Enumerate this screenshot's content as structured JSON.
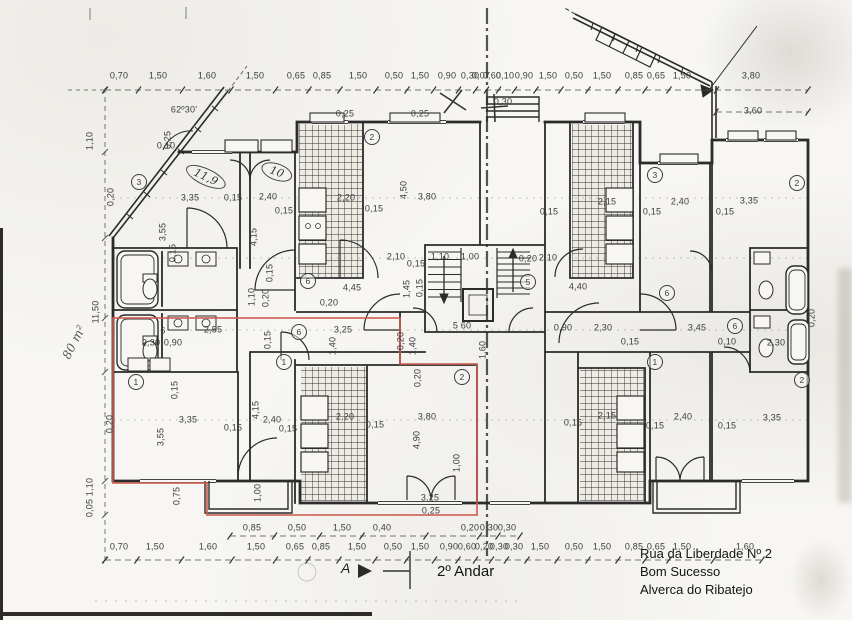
{
  "title": {
    "floor": "2º Andar",
    "section_marker": "A"
  },
  "address": {
    "line1": "Rua da Liberdade Nº 2",
    "line2": "Bom Sucesso",
    "line3": "Alverca do Ribatejo"
  },
  "colors": {
    "ink": "#2b2b2b",
    "red_outline": "#cd5c51",
    "paper": "#f7f6f2"
  },
  "dimension_rows": [
    {
      "name": "top",
      "y": 90,
      "label_y": 76,
      "x0": 105,
      "x1": 808,
      "labels": [
        {
          "t": "0,70",
          "x": 119
        },
        {
          "t": "1,50",
          "x": 158
        },
        {
          "t": "1,60",
          "x": 207
        },
        {
          "t": "1,50",
          "x": 255
        },
        {
          "t": "0,65",
          "x": 296
        },
        {
          "t": "0,85",
          "x": 322
        },
        {
          "t": "1,50",
          "x": 358
        },
        {
          "t": "0,50",
          "x": 394
        },
        {
          "t": "1,50",
          "x": 420
        },
        {
          "t": "0,90",
          "x": 447
        },
        {
          "t": "0,30",
          "x": 470
        },
        {
          "t": "0,07",
          "x": 481
        },
        {
          "t": "0,60",
          "x": 492
        },
        {
          "t": "0,10",
          "x": 505
        },
        {
          "t": "0,90",
          "x": 524
        },
        {
          "t": "1,50",
          "x": 548
        },
        {
          "t": "0,50",
          "x": 574
        },
        {
          "t": "1,50",
          "x": 602
        },
        {
          "t": "0,85",
          "x": 634
        },
        {
          "t": "0,65",
          "x": 656
        },
        {
          "t": "1,50",
          "x": 682
        },
        {
          "t": "3,80",
          "x": 751
        }
      ]
    },
    {
      "name": "top-extra",
      "y": 112,
      "label_y": 111,
      "x0": 716,
      "x1": 808,
      "labels": [
        {
          "t": "3,60",
          "x": 753
        }
      ]
    },
    {
      "name": "bottom",
      "y": 560,
      "label_y": 547,
      "x0": 105,
      "x1": 762,
      "labels": [
        {
          "t": "0,70",
          "x": 119
        },
        {
          "t": "1,50",
          "x": 155
        },
        {
          "t": "1,60",
          "x": 208
        },
        {
          "t": "1,50",
          "x": 256
        },
        {
          "t": "0,65",
          "x": 295
        },
        {
          "t": "0,85",
          "x": 321
        },
        {
          "t": "1,50",
          "x": 357
        },
        {
          "t": "0,50",
          "x": 393
        },
        {
          "t": "1,50",
          "x": 420
        },
        {
          "t": "0,90",
          "x": 449
        },
        {
          "t": "0,60",
          "x": 467
        },
        {
          "t": "0,20",
          "x": 484
        },
        {
          "t": "0,30",
          "x": 499
        },
        {
          "t": "0,30",
          "x": 514
        },
        {
          "t": "1,50",
          "x": 540
        },
        {
          "t": "0,50",
          "x": 574
        },
        {
          "t": "1,50",
          "x": 602
        },
        {
          "t": "0,85",
          "x": 634
        },
        {
          "t": "0,65",
          "x": 656
        },
        {
          "t": "1,50",
          "x": 682
        },
        {
          "t": "1,60",
          "x": 745
        }
      ]
    },
    {
      "name": "bottom-inner",
      "y": 536,
      "label_y": 528,
      "x0": 230,
      "x1": 520,
      "labels": [
        {
          "t": "0,85",
          "x": 252
        },
        {
          "t": "0,50",
          "x": 297
        },
        {
          "t": "1,50",
          "x": 342
        },
        {
          "t": "0,40",
          "x": 382
        },
        {
          "t": "0,20",
          "x": 470
        },
        {
          "t": "0,30",
          "x": 489
        },
        {
          "t": "0,30",
          "x": 507
        }
      ]
    }
  ],
  "plan_labels": [
    {
      "t": "3,35",
      "x": 190,
      "y": 198
    },
    {
      "t": "0,15",
      "x": 233,
      "y": 198
    },
    {
      "t": "2,40",
      "x": 268,
      "y": 197
    },
    {
      "t": "0,15",
      "x": 284,
      "y": 211
    },
    {
      "t": "3,55",
      "x": 163,
      "y": 232,
      "r": 90
    },
    {
      "t": "4,15",
      "x": 254,
      "y": 237,
      "r": 90
    },
    {
      "t": "0,15",
      "x": 173,
      "y": 253,
      "r": 90
    },
    {
      "t": "0,15",
      "x": 270,
      "y": 273,
      "r": 90
    },
    {
      "t": "1,10",
      "x": 252,
      "y": 297,
      "r": 90
    },
    {
      "t": "0,20",
      "x": 266,
      "y": 298,
      "r": 90
    },
    {
      "t": "0,20",
      "x": 111,
      "y": 197,
      "r": 90
    },
    {
      "t": "0,10",
      "x": 166,
      "y": 146
    },
    {
      "t": "0,25",
      "x": 345,
      "y": 114
    },
    {
      "t": "0,25",
      "x": 420,
      "y": 114
    },
    {
      "t": "0,30",
      "x": 503,
      "y": 102
    },
    {
      "t": "2,20",
      "x": 346,
      "y": 198
    },
    {
      "t": "0,15",
      "x": 374,
      "y": 209
    },
    {
      "t": "3,80",
      "x": 427,
      "y": 197
    },
    {
      "t": "4,50",
      "x": 404,
      "y": 190,
      "r": 90
    },
    {
      "t": "2,10",
      "x": 396,
      "y": 257
    },
    {
      "t": "0,15",
      "x": 416,
      "y": 264
    },
    {
      "t": "1,10",
      "x": 440,
      "y": 257
    },
    {
      "t": "1,00",
      "x": 470,
      "y": 257
    },
    {
      "t": "4,45",
      "x": 352,
      "y": 288
    },
    {
      "t": "1,45",
      "x": 407,
      "y": 289,
      "r": 90
    },
    {
      "t": "0,15",
      "x": 420,
      "y": 288,
      "r": 90
    },
    {
      "t": "0,20",
      "x": 329,
      "y": 303
    },
    {
      "t": "6",
      "x": 163,
      "y": 331
    },
    {
      "t": "2,55",
      "x": 213,
      "y": 330
    },
    {
      "t": "0,90",
      "x": 173,
      "y": 343
    },
    {
      "t": "2,30",
      "x": 151,
      "y": 343
    },
    {
      "t": "3,25",
      "x": 343,
      "y": 330
    },
    {
      "t": "1,40",
      "x": 333,
      "y": 346,
      "r": 90
    },
    {
      "t": "0,15",
      "x": 268,
      "y": 340,
      "r": 90
    },
    {
      "t": "5 60",
      "x": 462,
      "y": 326
    },
    {
      "t": "1,60",
      "x": 483,
      "y": 350,
      "r": 90
    },
    {
      "t": "1,40",
      "x": 413,
      "y": 346,
      "r": 90
    },
    {
      "t": "0,20",
      "x": 401,
      "y": 341,
      "r": 90
    },
    {
      "t": "0,90",
      "x": 563,
      "y": 328
    },
    {
      "t": "2,30",
      "x": 603,
      "y": 328
    },
    {
      "t": "3,45",
      "x": 697,
      "y": 328
    },
    {
      "t": "0,15",
      "x": 630,
      "y": 342
    },
    {
      "t": "0,10",
      "x": 727,
      "y": 342
    },
    {
      "t": "2,30",
      "x": 776,
      "y": 343
    },
    {
      "t": "0,20",
      "x": 812,
      "y": 318,
      "r": 90
    },
    {
      "t": "4,40",
      "x": 578,
      "y": 287
    },
    {
      "t": "2,10",
      "x": 548,
      "y": 258
    },
    {
      "t": "0,20",
      "x": 528,
      "y": 259
    },
    {
      "t": "0,15",
      "x": 549,
      "y": 212
    },
    {
      "t": "2,15",
      "x": 607,
      "y": 202
    },
    {
      "t": "0,15",
      "x": 652,
      "y": 212
    },
    {
      "t": "2,40",
      "x": 680,
      "y": 202
    },
    {
      "t": "0,15",
      "x": 725,
      "y": 212
    },
    {
      "t": "3,35",
      "x": 749,
      "y": 201
    },
    {
      "t": "3,35",
      "x": 188,
      "y": 420
    },
    {
      "t": "0,15",
      "x": 233,
      "y": 428
    },
    {
      "t": "2,40",
      "x": 272,
      "y": 420
    },
    {
      "t": "0,15",
      "x": 288,
      "y": 429
    },
    {
      "t": "3,55",
      "x": 161,
      "y": 437,
      "r": 90
    },
    {
      "t": "4,15",
      "x": 256,
      "y": 410,
      "r": 90
    },
    {
      "t": "0,15",
      "x": 175,
      "y": 390,
      "r": 90
    },
    {
      "t": "0,20",
      "x": 110,
      "y": 424,
      "r": 90
    },
    {
      "t": "0,75",
      "x": 177,
      "y": 496,
      "r": 90
    },
    {
      "t": "1,00",
      "x": 258,
      "y": 493,
      "r": 90
    },
    {
      "t": "2,20",
      "x": 345,
      "y": 417
    },
    {
      "t": "0,15",
      "x": 375,
      "y": 425
    },
    {
      "t": "3,80",
      "x": 427,
      "y": 417
    },
    {
      "t": "4,90",
      "x": 417,
      "y": 440,
      "r": 90
    },
    {
      "t": "0,20",
      "x": 418,
      "y": 378,
      "r": 90
    },
    {
      "t": "3,25",
      "x": 430,
      "y": 498
    },
    {
      "t": "0,25",
      "x": 431,
      "y": 511
    },
    {
      "t": "1,00",
      "x": 457,
      "y": 463,
      "r": 90
    },
    {
      "t": "0,15",
      "x": 573,
      "y": 423
    },
    {
      "t": "2,15",
      "x": 607,
      "y": 416
    },
    {
      "t": "0,15",
      "x": 655,
      "y": 426
    },
    {
      "t": "2,40",
      "x": 683,
      "y": 417
    },
    {
      "t": "0,15",
      "x": 727,
      "y": 426
    },
    {
      "t": "3,35",
      "x": 772,
      "y": 418
    },
    {
      "t": "1,10",
      "x": 90,
      "y": 141,
      "r": 90
    },
    {
      "t": "11,50",
      "x": 96,
      "y": 312,
      "r": 90
    },
    {
      "t": "1,10",
      "x": 90,
      "y": 487,
      "r": 90
    },
    {
      "t": "0,05",
      "x": 90,
      "y": 508,
      "r": 90
    },
    {
      "t": "62º30'",
      "x": 184,
      "y": 110
    },
    {
      "t": "0,25",
      "x": 168,
      "y": 140,
      "r": 90
    },
    {
      "t": "80 m²",
      "x": 74,
      "y": 342,
      "r": 63,
      "c": "hand"
    },
    {
      "t": "11,9",
      "x": 206,
      "y": 177,
      "r": -25,
      "c": "ell"
    },
    {
      "t": "10",
      "x": 277,
      "y": 172,
      "r": -20,
      "c": "ell"
    },
    {
      "t": "3",
      "x": 139,
      "y": 182,
      "c": "circ"
    },
    {
      "t": "2",
      "x": 372,
      "y": 137,
      "c": "circ"
    },
    {
      "t": "3",
      "x": 655,
      "y": 175,
      "c": "circ"
    },
    {
      "t": "2",
      "x": 797,
      "y": 183,
      "c": "circ"
    },
    {
      "t": "5",
      "x": 528,
      "y": 282,
      "c": "circ"
    },
    {
      "t": "6",
      "x": 308,
      "y": 281,
      "c": "circ"
    },
    {
      "t": "6",
      "x": 667,
      "y": 293,
      "c": "circ"
    },
    {
      "t": "6",
      "x": 299,
      "y": 332,
      "c": "circ"
    },
    {
      "t": "6",
      "x": 735,
      "y": 326,
      "c": "circ"
    },
    {
      "t": "1",
      "x": 136,
      "y": 382,
      "c": "circ"
    },
    {
      "t": "1",
      "x": 284,
      "y": 362,
      "c": "circ"
    },
    {
      "t": "2",
      "x": 462,
      "y": 377,
      "c": "circ"
    },
    {
      "t": "1",
      "x": 655,
      "y": 362,
      "c": "circ"
    },
    {
      "t": "2",
      "x": 802,
      "y": 380,
      "c": "circ"
    }
  ]
}
